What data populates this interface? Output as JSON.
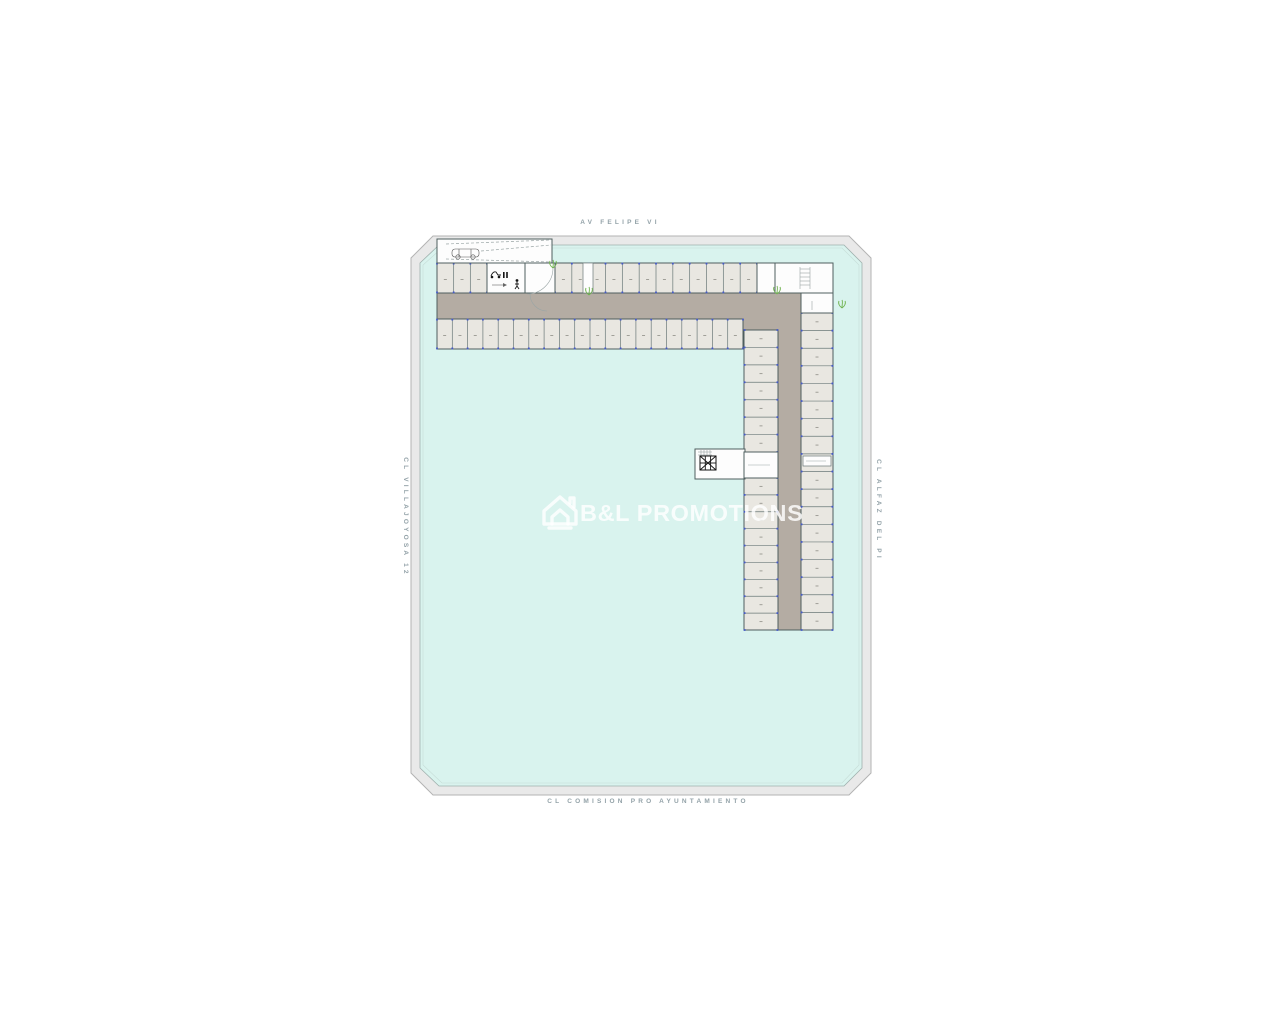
{
  "streets": {
    "top": "AV FELIPE VI",
    "bottom": "CL COMISION PRO AYUNTAMIENTO",
    "left": "CL VILLAJOYOSA 12",
    "right": "CL ALFAZ DEL PI"
  },
  "watermark": {
    "brand": "B&L PROMOTIONS",
    "logo": "house-icon"
  },
  "plan": {
    "kind": "underground-parking-floor-plan",
    "icons": [
      "car-icon",
      "motorbike-icon",
      "pedestrian-icon",
      "elevator-icon",
      "stairs-icon",
      "plant-icon"
    ],
    "colors": {
      "site": "#d9f3ee",
      "sidewalk": "#e9e9e9",
      "sidewalk_edge": "#b3b3b3",
      "curb": "#9fb0ad",
      "aisle": "#b4aca3",
      "space": "#e9e7e1",
      "wall": "#4e5e5e",
      "divider": "#6a7878",
      "marker": "#4459c8",
      "cell_mark": "#a09f98",
      "plant": "#6fb24e",
      "label": "#93a2a8",
      "watermark": "rgba(255,255,255,0.82)"
    },
    "rows": [
      {
        "name": "top-row-left",
        "dir": "v",
        "x0": 437,
        "x1": 487,
        "y0": 263,
        "y1": 293,
        "n": 3
      },
      {
        "name": "top-row-main",
        "dir": "v",
        "x0": 555,
        "x1": 757,
        "y0": 263,
        "y1": 293,
        "n": 12
      },
      {
        "name": "bottom-row",
        "dir": "v",
        "x0": 437,
        "x1": 743,
        "y0": 319,
        "y1": 349,
        "n": 20
      },
      {
        "name": "inner-col-upper",
        "dir": "h",
        "x0": 744,
        "x1": 778,
        "y0": 330,
        "y1": 452,
        "n": 7
      },
      {
        "name": "inner-col-lower",
        "dir": "h",
        "x0": 744,
        "x1": 778,
        "y0": 478,
        "y1": 630,
        "n": 9
      },
      {
        "name": "outer-col",
        "dir": "h",
        "x0": 801,
        "x1": 833,
        "y0": 313,
        "y1": 630,
        "n": 18
      }
    ]
  }
}
